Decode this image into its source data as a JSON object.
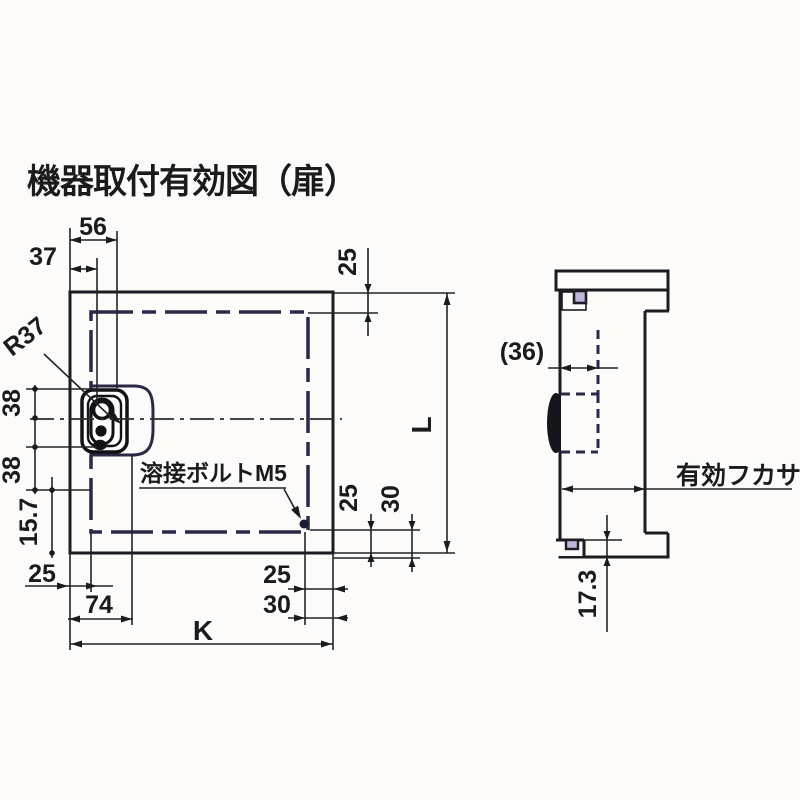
{
  "title": "機器取付有効図（扉）",
  "colors": {
    "panel_fill": "#c4b6dc",
    "dash_border": "#2a2947",
    "line": "#1b1b1b",
    "background": "#fcfbf9"
  },
  "front_view": {
    "dim_56": "56",
    "dim_37": "37",
    "dim_25_top": "25",
    "radius_label": "R37",
    "dim_38_a": "38",
    "dim_38_b": "38",
    "dim_15_7": "15.7",
    "dim_25_left": "25",
    "weld_bolt_label": "溶接ボルトM5",
    "dim_25_bottom_left": "25",
    "dim_74": "74",
    "dim_k": "K",
    "dim_25_bottom_right": "25",
    "dim_30_bottom_right": "30",
    "dim_25_right": "25",
    "dim_30_right": "30",
    "dim_l": "L"
  },
  "side_view": {
    "dim_36": "(36)",
    "depth_label": "有効フカサ",
    "dim_17_3": "17.3"
  }
}
